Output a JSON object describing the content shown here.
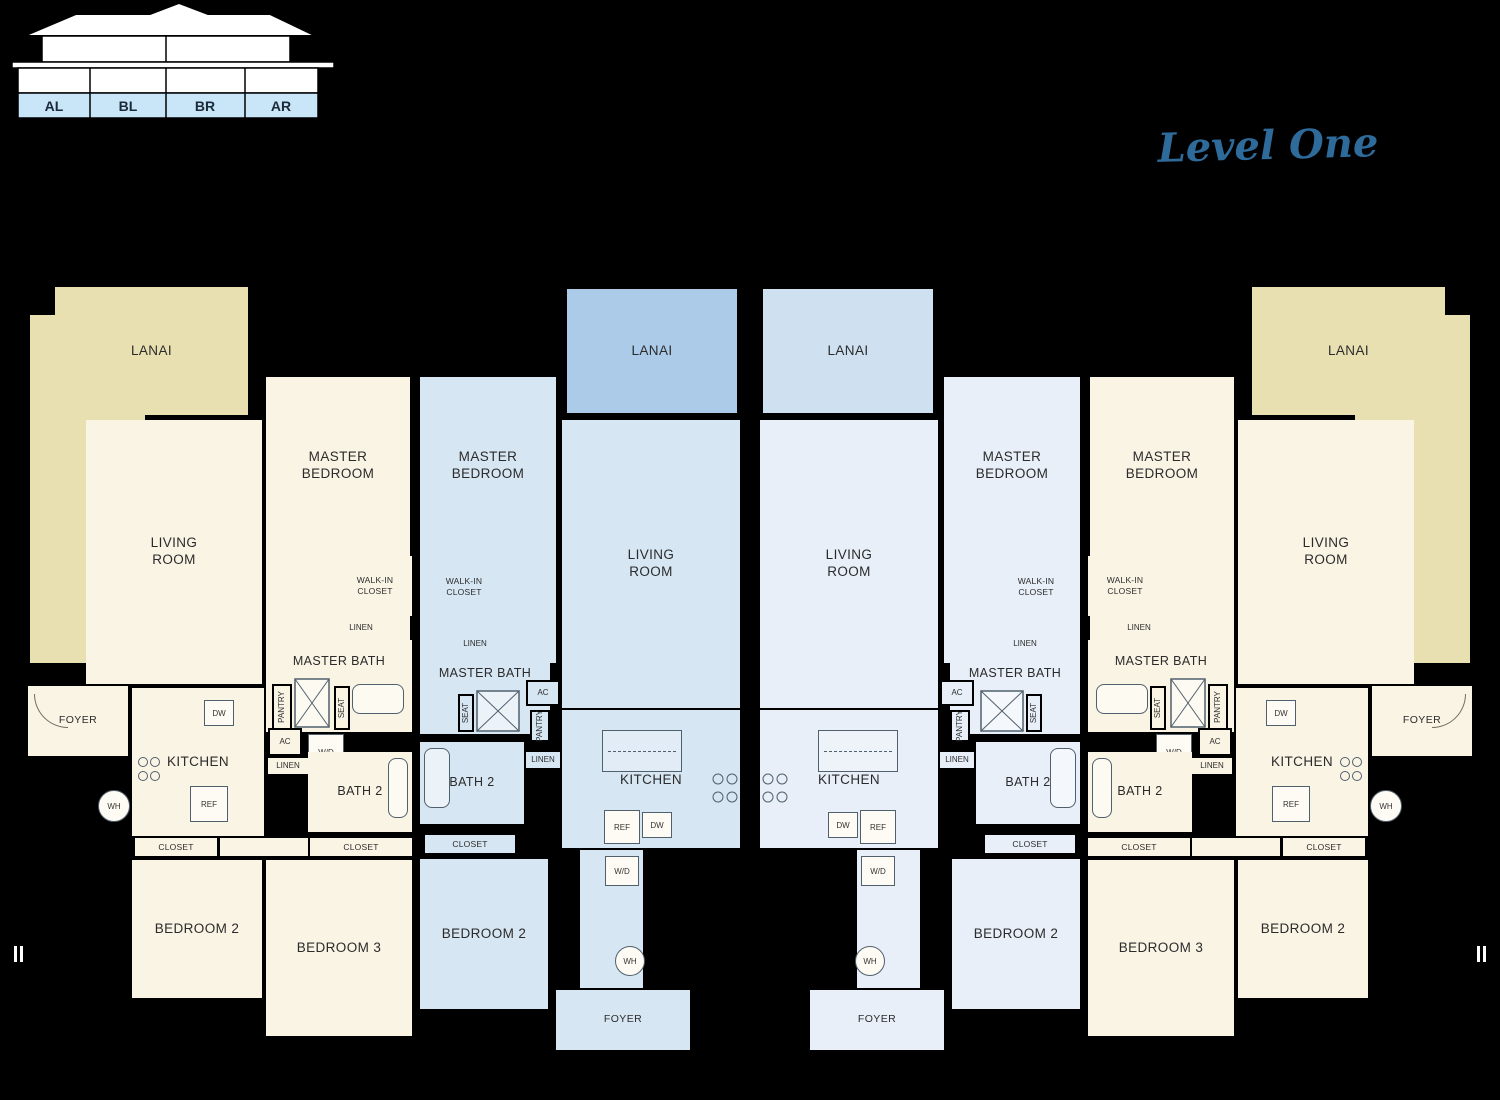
{
  "elevation": {
    "unit_labels": [
      "AL",
      "BL",
      "BR",
      "AR"
    ],
    "level_label": "Level One",
    "band_color": "#c9e5f8"
  },
  "rooms": {
    "lanai": "LANAI",
    "living_room": "LIVING\nROOM",
    "master_bedroom": "MASTER\nBEDROOM",
    "walk_in_closet": "WALK-IN\nCLOSET",
    "master_bath": "MASTER BATH",
    "bath_2": "BATH 2",
    "bedroom_2": "BEDROOM 2",
    "bedroom_3": "BEDROOM 3",
    "kitchen": "KITCHEN",
    "foyer": "FOYER",
    "closet": "CLOSET",
    "linen": "LINEN",
    "pantry": "PANTRY",
    "seat": "SEAT",
    "ac": "AC",
    "wd": "W/D",
    "dw": "DW",
    "ref": "REF",
    "wh": "WH"
  },
  "colors": {
    "unit_a_fill": "#faf4e5",
    "unit_a_lanai": "#e9e0b2",
    "unit_bl_fill": "#d7e6f3",
    "unit_bl_lanai": "#abcbe8",
    "unit_br_fill": "#e8eff8",
    "unit_br_lanai": "#cfe0f0",
    "wall": "#000000",
    "level_text": "#2e6b9a"
  }
}
